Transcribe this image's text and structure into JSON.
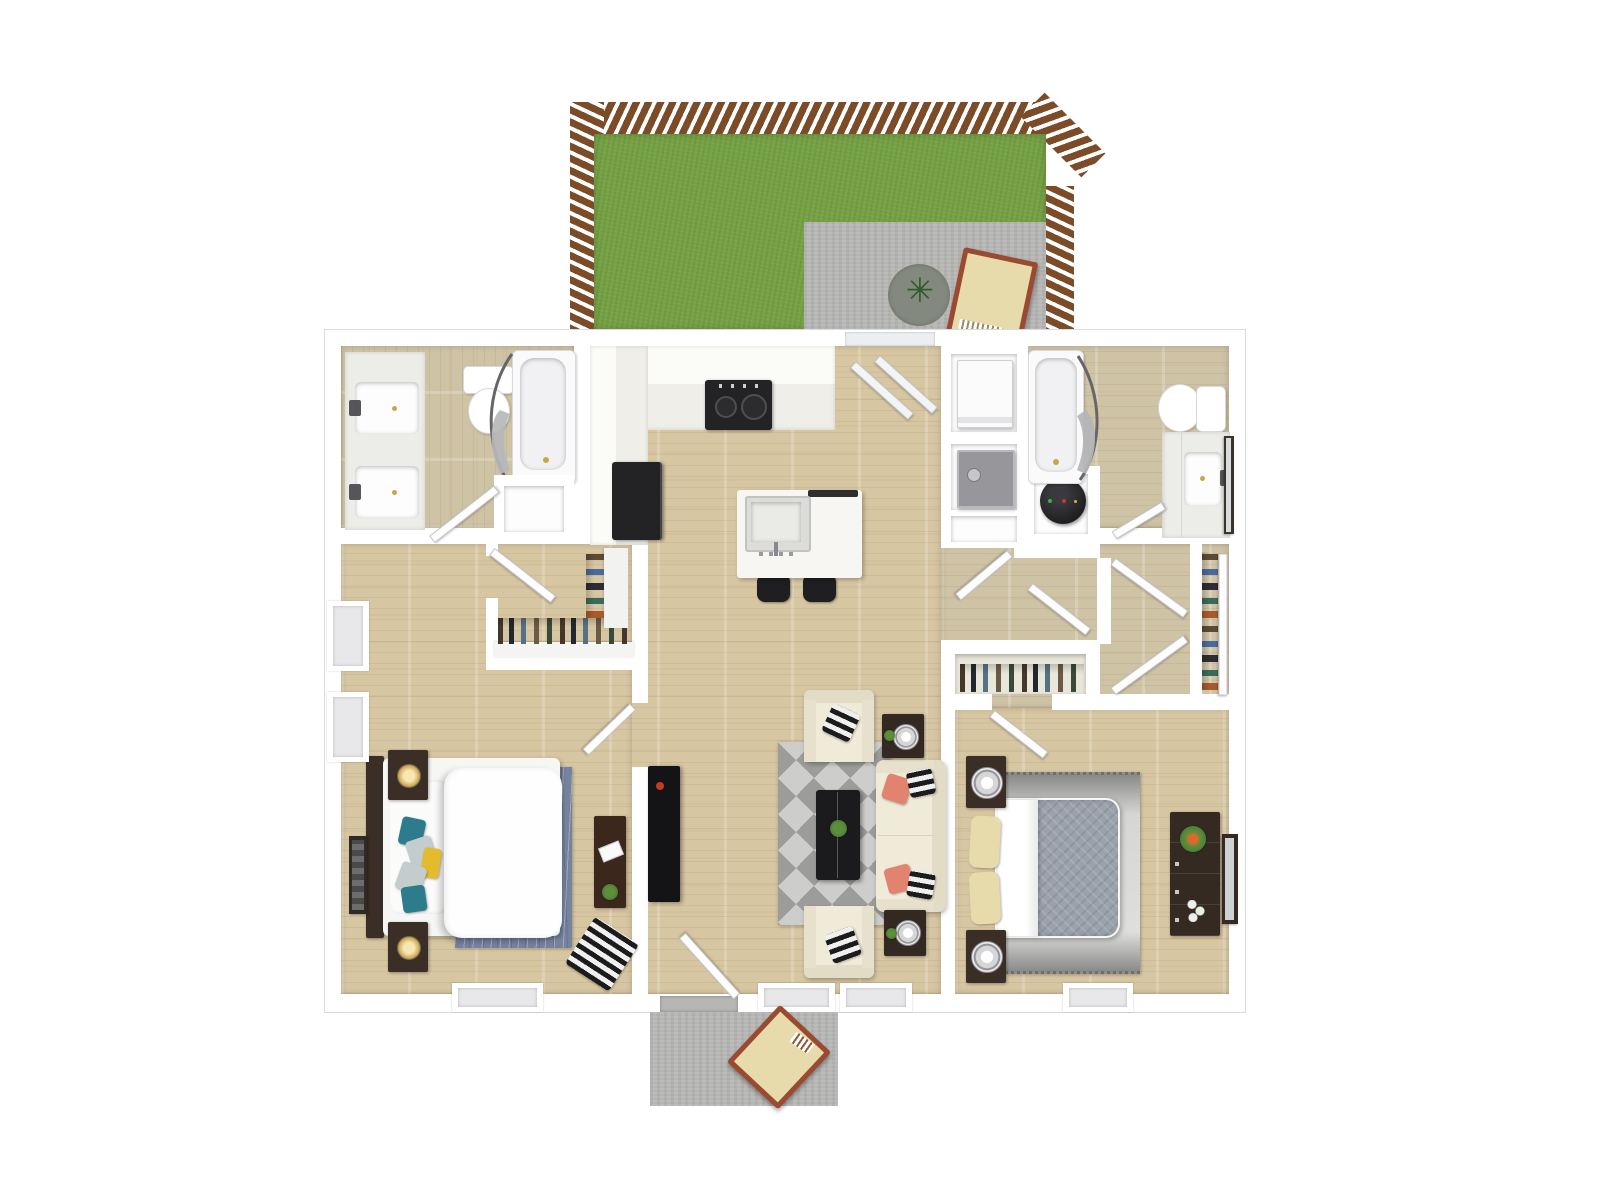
{
  "canvas": {
    "width": 1600,
    "height": 1200,
    "background": "#ffffff"
  },
  "palette": {
    "wall": "#ffffff",
    "wall_edge": "#dcdcde",
    "wood": "#d7c6a2",
    "wood_muted": "#cfc3a6",
    "grass": "#76a245",
    "patio": "#b6b6b4",
    "fence": "#7c4c28",
    "counter": "#f5f4f0",
    "black": "#1f1f21",
    "gray_appliance": "#97979b",
    "dark": "#3a2e26",
    "cream": "#f0ead9",
    "coral": "#e2836f",
    "teal": "#2c7c8c",
    "yellow": "#e5bb2e",
    "rug_blue": "#76839f",
    "rug_gray": "#9c9c9a",
    "rug_gray_light": "#cdcdcb",
    "bed_gray": "#9aa2ac",
    "tan": "#e8dbab",
    "chair_frame": "#9a4a31",
    "green": "#3f6f2f",
    "glow": "#e8c87a",
    "curtain": "#66666a"
  },
  "floor_plan": {
    "type": "3d-top-down-apartment-floor-plan",
    "outdoor": [
      {
        "name": "fenced-backyard",
        "features": [
          "wood-privacy-fence",
          "lawn",
          "concrete-patio",
          "round-outdoor-rug",
          "potted-plant",
          "wood-lounge-chair"
        ]
      },
      {
        "name": "front-porch",
        "features": [
          "concrete-pad",
          "wood-patio-chair"
        ]
      }
    ],
    "rooms": [
      {
        "name": "bathroom-1",
        "furniture": [
          "double-sink-vanity",
          "toilet",
          "bathtub-with-shower-curtain",
          "linen-niche"
        ]
      },
      {
        "name": "walk-in-closet-1",
        "furniture": [
          "hanging-clothes",
          "shelving"
        ]
      },
      {
        "name": "kitchen",
        "furniture": [
          "l-shaped-counter",
          "range",
          "refrigerator",
          "island-with-sink",
          "two-bar-stools",
          "sliding-glass-door"
        ]
      },
      {
        "name": "laundry-utility",
        "furniture": [
          "washer",
          "dryer",
          "storage-niche",
          "water-heater"
        ]
      },
      {
        "name": "bathroom-2",
        "furniture": [
          "bathtub-with-shower-curtain",
          "toilet",
          "single-sink-vanity",
          "leaning-mirror"
        ]
      },
      {
        "name": "hallway",
        "furniture": [
          "double-door-closet",
          "hanging-clothes",
          "linen-closet"
        ]
      },
      {
        "name": "bedroom-1",
        "furniture": [
          "bed",
          "headboard",
          "two-nightstands-with-lamps",
          "blue-area-rug",
          "desk",
          "wall-art",
          "chevron-floor-pillow",
          "accent-pillows"
        ]
      },
      {
        "name": "living-room",
        "furniture": [
          "sofa",
          "two-armchairs",
          "two-end-tables-with-lamps",
          "coffee-table",
          "media-console",
          "geometric-rug",
          "front-door"
        ]
      },
      {
        "name": "bedroom-2",
        "furniture": [
          "bed",
          "two-nightstands-with-lamps",
          "ombre-rug",
          "dresser-with-plant",
          "leaning-mirror",
          "reach-in-closet"
        ]
      }
    ]
  }
}
